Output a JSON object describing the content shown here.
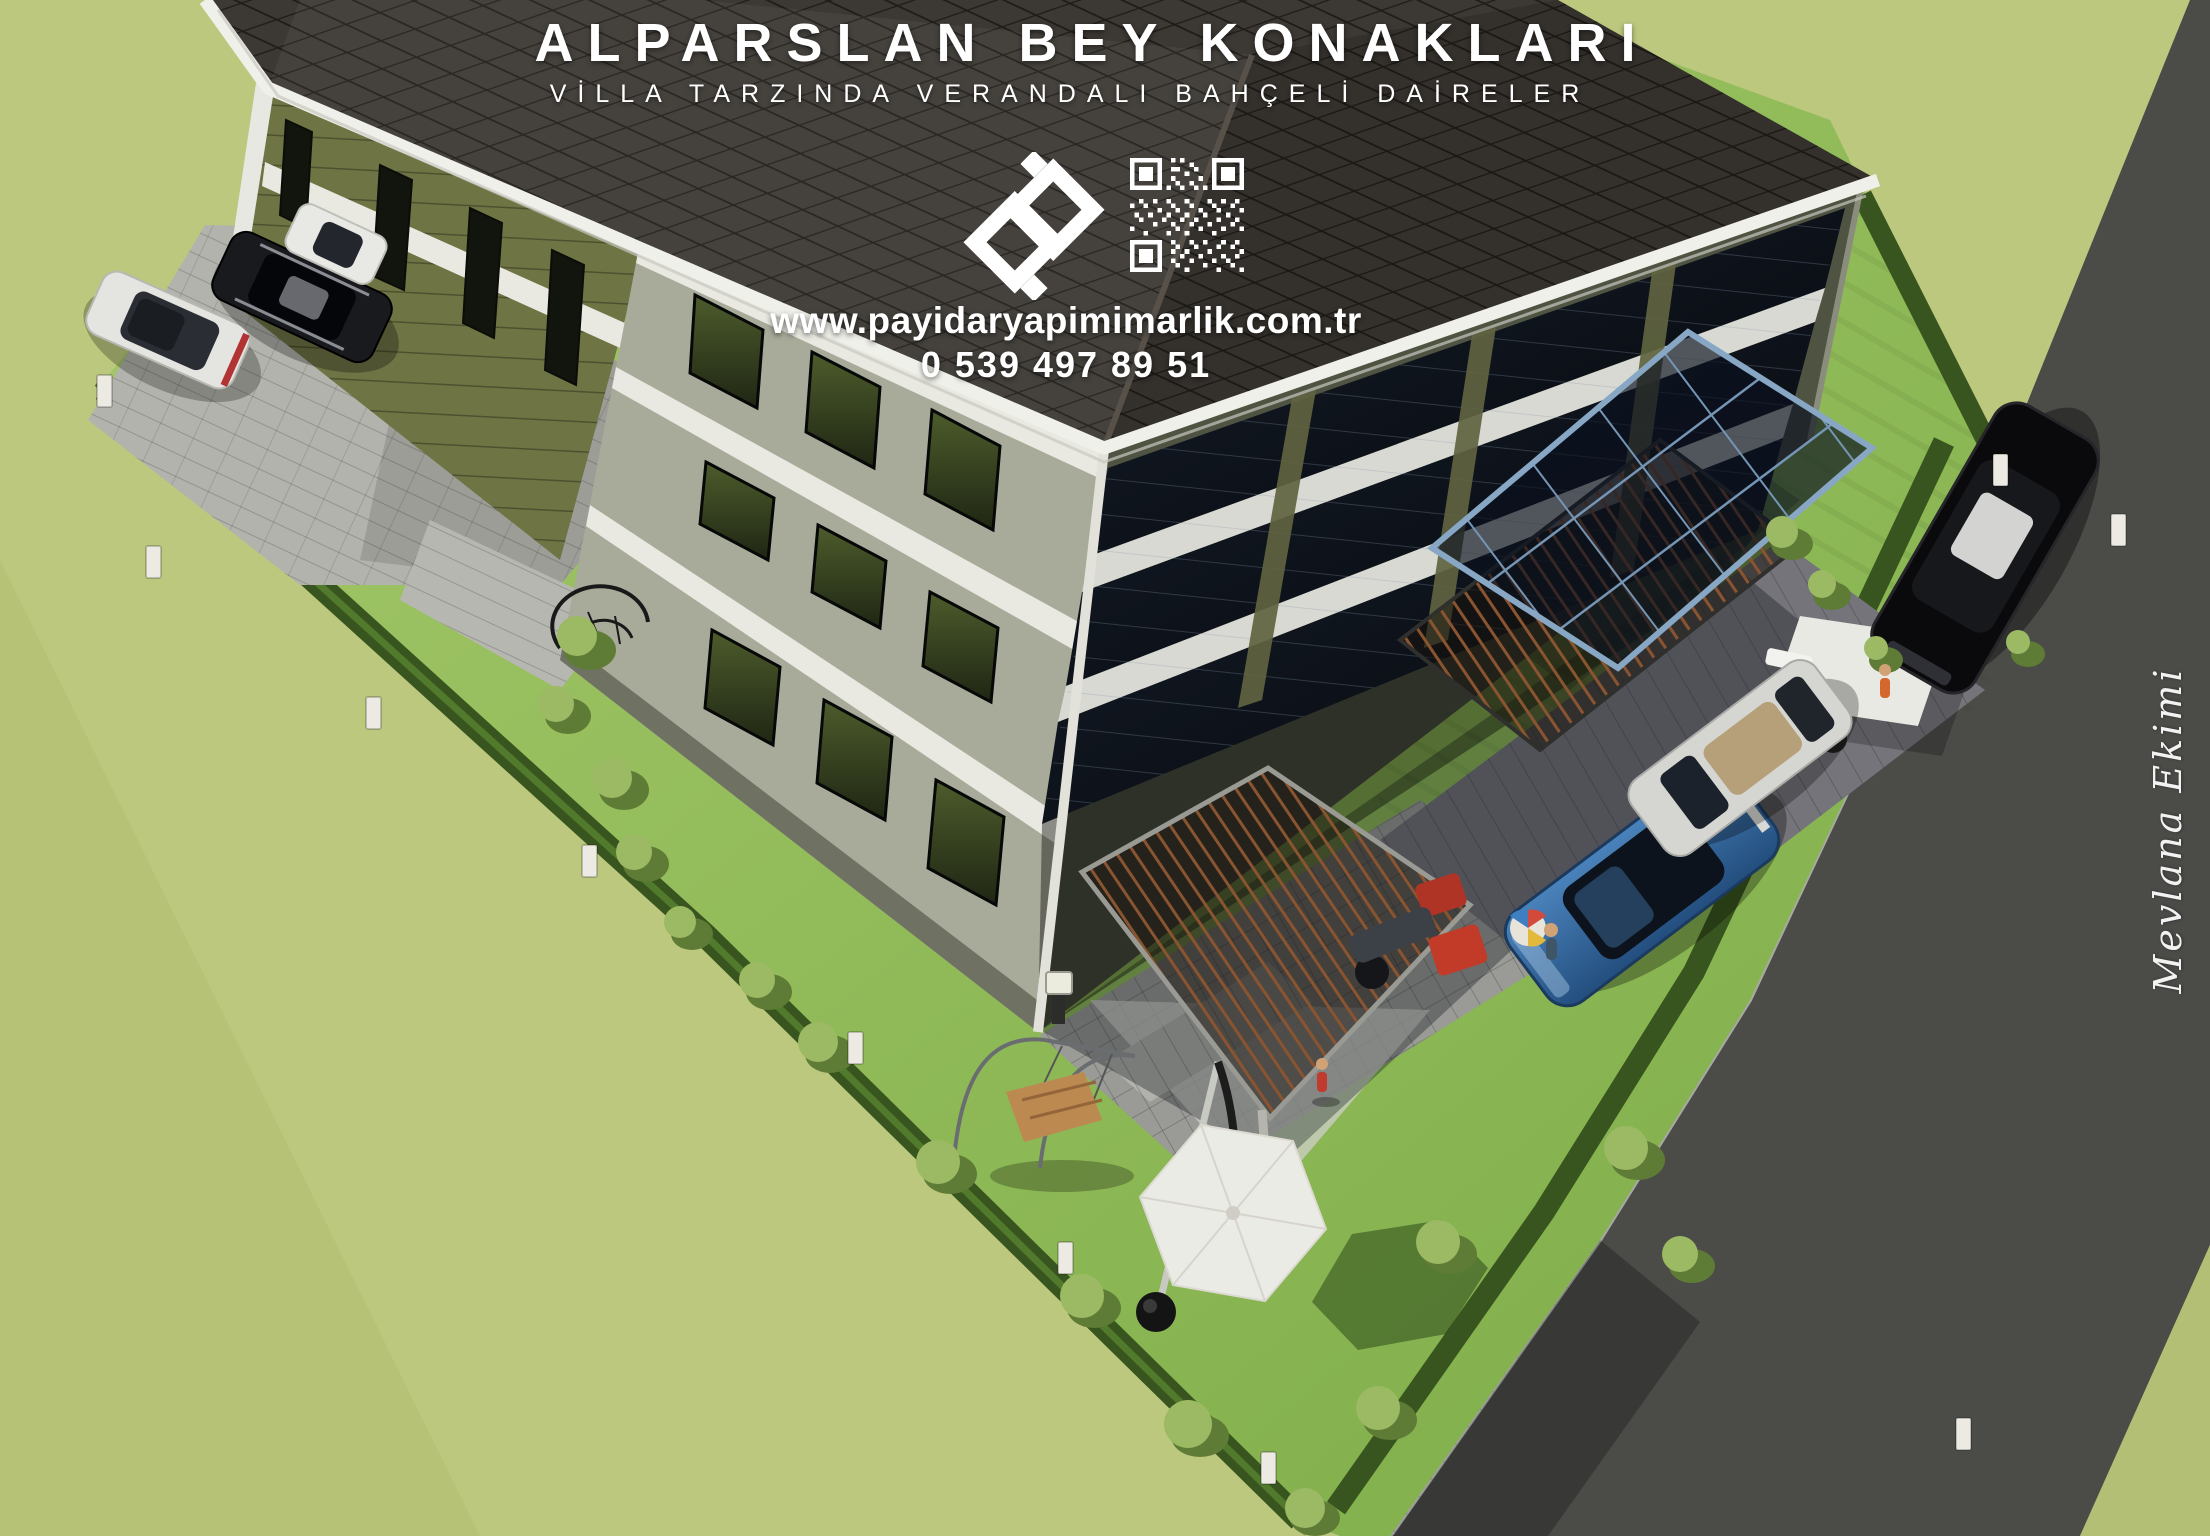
{
  "header": {
    "title": "ALPARSLAN BEY KONAKLARI",
    "subtitle": "VİLLA TARZINDA VERANDALI BAHÇELİ DAİRELER"
  },
  "contact": {
    "website": "www.payidaryapimimarlik.com.tr",
    "phone": "0 539 497 89 51"
  },
  "watermark": {
    "signature": "Mevlana Ekimi"
  },
  "branding": {
    "logo_icon": "payidar-logo-icon",
    "qr_icon": "qr-code-icon"
  },
  "palette": {
    "field_grass": "#bcc87e",
    "lawn_green": "#8fbc55",
    "hedge_green": "#39551f",
    "road_asphalt": "#4b4b48",
    "roof_tile": "#3c3833",
    "fascia_white": "#f0f0ea",
    "wall_light": "#a8aa9a",
    "siding_olive": "#6f7444",
    "glass_dark": "#0e1319",
    "pergola_wood": "#8a5430",
    "canopy_frame_blue": "#87a7c5",
    "car_blue": "#2f639b",
    "umbrella_white": "#ebebe5",
    "text_white": "#ffffff"
  }
}
